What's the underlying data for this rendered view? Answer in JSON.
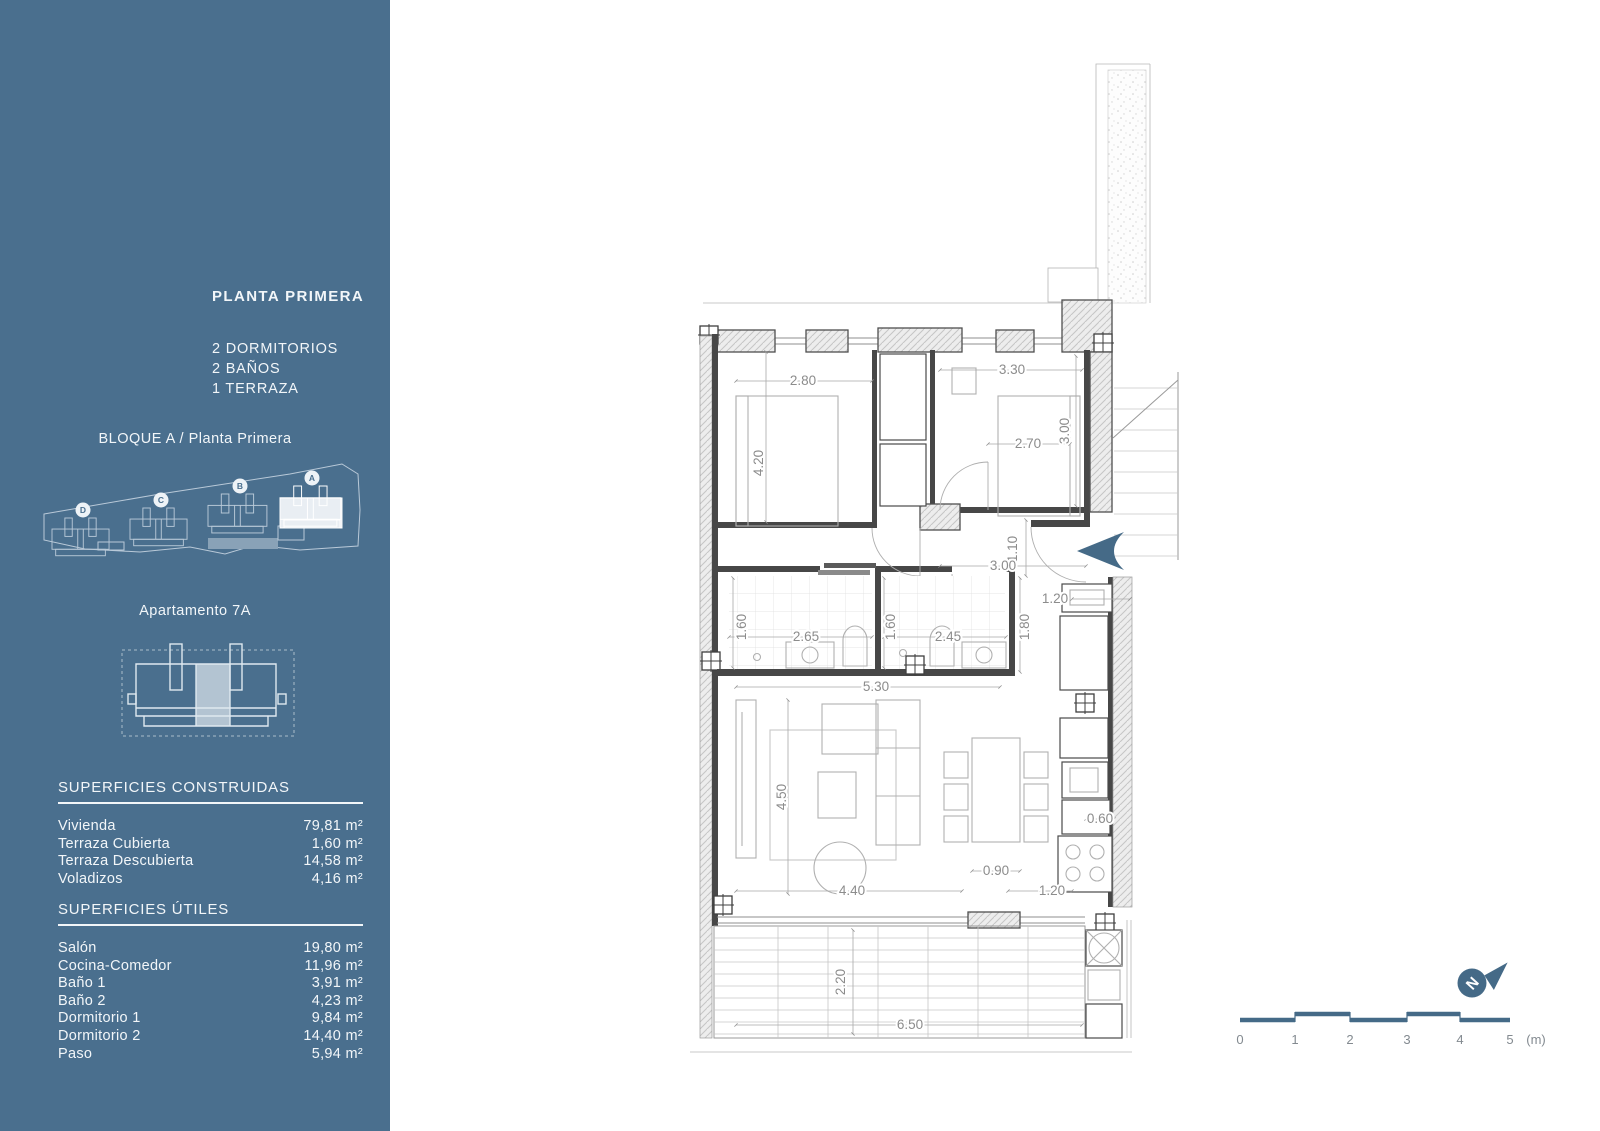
{
  "sidebar": {
    "title": "PLANTA PRIMERA",
    "features": [
      "2 DORMITORIOS",
      "2 BAÑOS",
      "1 TERRAZA"
    ],
    "block_label": "BLOQUE A / Planta Primera",
    "apartment_label": "Apartamento 7A",
    "sections": [
      {
        "title": "SUPERFICIES CONSTRUIDAS",
        "rows": [
          {
            "label": "Vivienda",
            "value": "79,81 m²"
          },
          {
            "label": "Terraza Cubierta",
            "value": "1,60 m²"
          },
          {
            "label": "Terraza Descubierta",
            "value": "14,58 m²"
          },
          {
            "label": "Voladizos",
            "value": "4,16 m²"
          }
        ]
      },
      {
        "title": "SUPERFICIES ÚTILES",
        "rows": [
          {
            "label": "Salón",
            "value": "19,80 m²"
          },
          {
            "label": "Cocina-Comedor",
            "value": "11,96 m²"
          },
          {
            "label": "Baño 1",
            "value": "3,91 m²"
          },
          {
            "label": "Baño 2",
            "value": "4,23 m²"
          },
          {
            "label": "Dormitorio 1",
            "value": "9,84 m²"
          },
          {
            "label": "Dormitorio 2",
            "value": "14,40 m²"
          },
          {
            "label": "Paso",
            "value": "5,94 m²"
          }
        ]
      }
    ]
  },
  "site": {
    "badges": [
      "D",
      "C",
      "B",
      "A"
    ]
  },
  "dims": {
    "bed1_w": "2.80",
    "bed2_w": "3.30",
    "bed1_h": "4.20",
    "bed2_h": "3.00",
    "bed2_bed": "2.70",
    "entry_w": "1.10",
    "hall_w": "3.00",
    "kitchen_top": "1.20",
    "kitchen_side": "1.80",
    "bath1_h": "1.60",
    "bath1_w": "2.65",
    "bath2_h": "1.60",
    "bath2_w": "2.45",
    "living_w": "5.30",
    "living_h": "4.50",
    "table_w": "0.90",
    "living_bw": "4.40",
    "living_bw2": "1.20",
    "counter_w": "0.60",
    "terrace_h": "2.20",
    "terrace_w": "6.50"
  },
  "scale": {
    "labels": [
      "0",
      "1",
      "2",
      "3",
      "4",
      "5"
    ],
    "unit": "(m)"
  },
  "compass": {
    "letter": "N"
  },
  "colors": {
    "sidebar": "#4a6f8e",
    "accent": "#456a87",
    "wall": "#474747",
    "dim": "#8c8c8c",
    "furn": "#b0b0b0",
    "siteline": "#b9c9d8",
    "hl": "#e9eef3"
  }
}
